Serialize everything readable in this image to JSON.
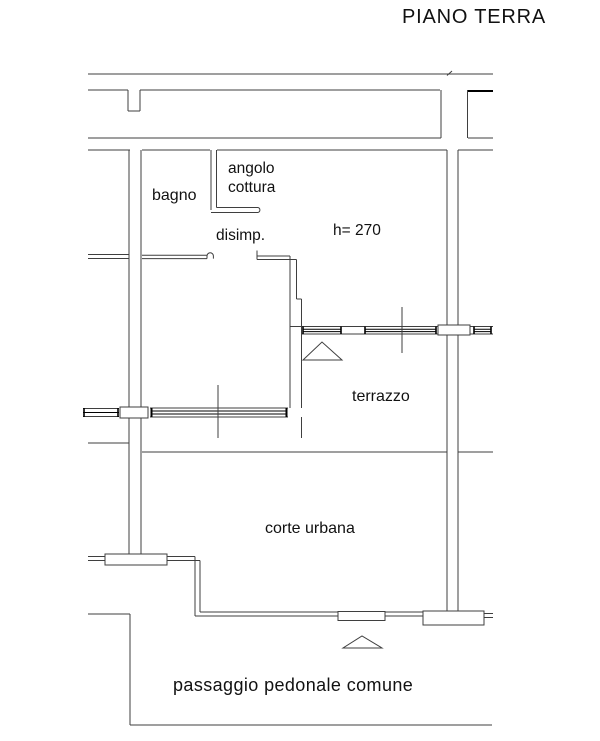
{
  "plan": {
    "title": "PIANO TERRA",
    "floor_height_note": "h= 270"
  },
  "labels": {
    "bagno": "bagno",
    "angolo_cottura_line1": "angolo",
    "angolo_cottura_line2": "cottura",
    "disimpegno": "disimp.",
    "height_note": "h= 270",
    "terrazzo": "terrazzo",
    "corte_urbana": "corte urbana",
    "passaggio": "passaggio pedonale comune"
  },
  "colors": {
    "background": "#ffffff",
    "wall_line": "#3f3f3f",
    "window_dark_line": "#000000",
    "text": "#111111"
  }
}
